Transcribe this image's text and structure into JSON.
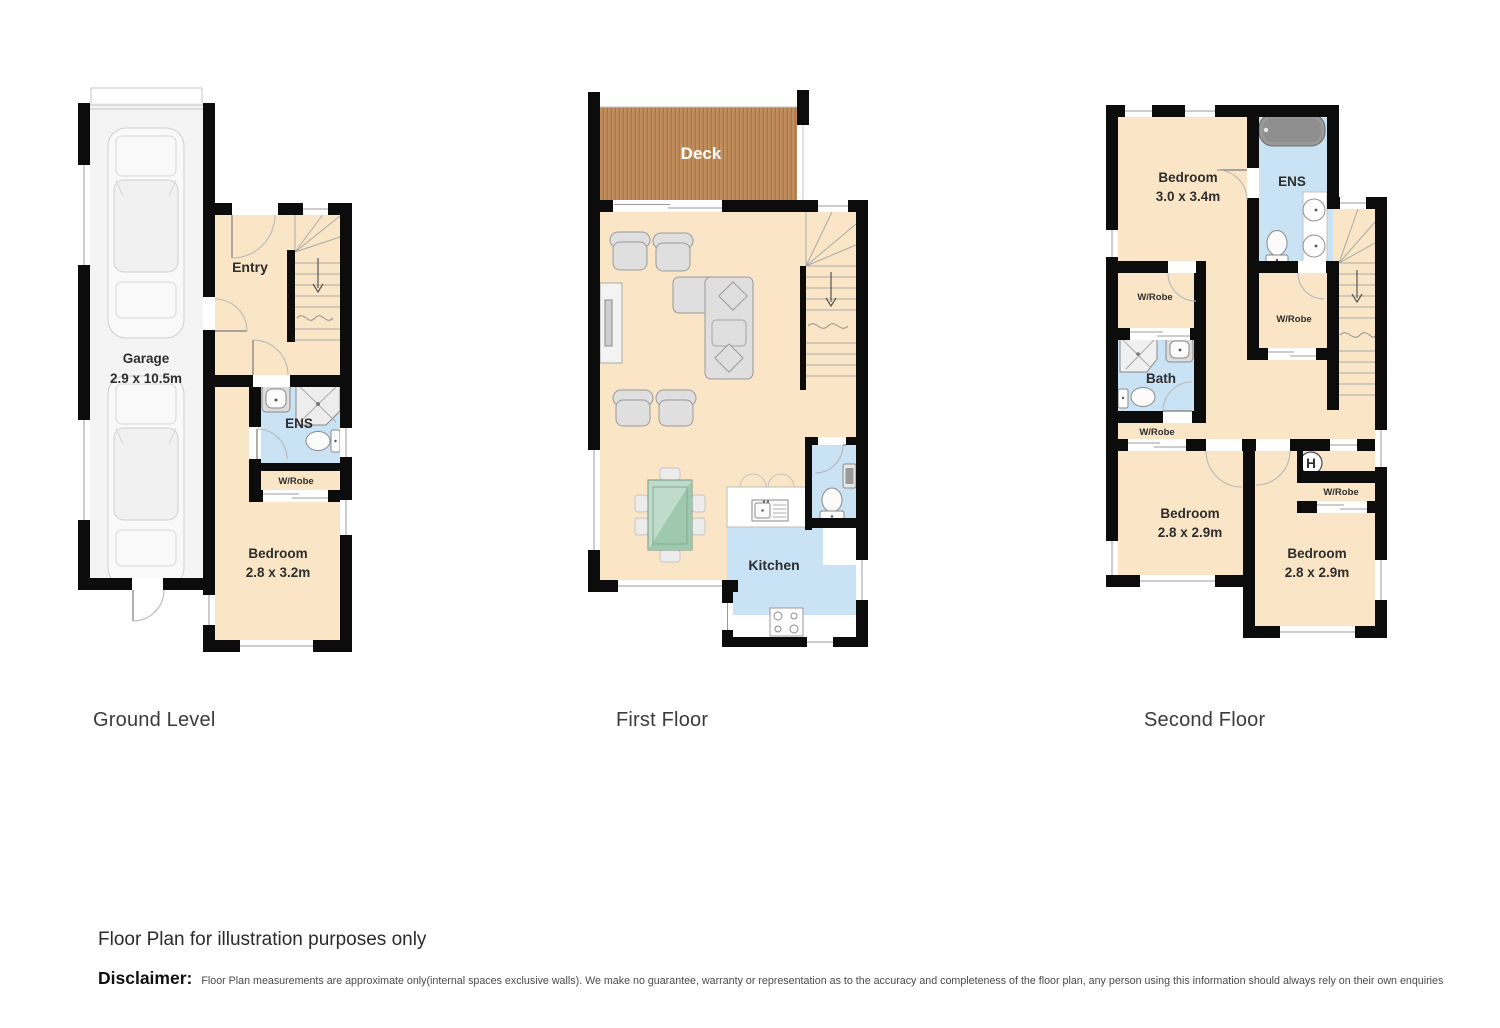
{
  "floors": {
    "ground": {
      "title": "Ground Level",
      "rooms": {
        "garage": {
          "name": "Garage",
          "dims": "2.9 x 10.5m"
        },
        "entry": {
          "name": "Entry"
        },
        "ens": {
          "name": "ENS"
        },
        "wrobe": {
          "name": "W/Robe"
        },
        "bedroom": {
          "name": "Bedroom",
          "dims": "2.8 x 3.2m"
        }
      }
    },
    "first": {
      "title": "First Floor",
      "rooms": {
        "deck": {
          "name": "Deck"
        },
        "kitchen": {
          "name": "Kitchen"
        }
      }
    },
    "second": {
      "title": "Second Floor",
      "rooms": {
        "bedroom1": {
          "name": "Bedroom",
          "dims": "3.0 x 3.4m"
        },
        "ens": {
          "name": "ENS"
        },
        "wrobe_left": {
          "name": "W/Robe"
        },
        "wrobe_center": {
          "name": "W/Robe"
        },
        "bath": {
          "name": "Bath"
        },
        "wrobe_small": {
          "name": "W/Robe"
        },
        "bedroom2": {
          "name": "Bedroom",
          "dims": "2.8 x 2.9m"
        },
        "hotwater": {
          "name": "H"
        },
        "wrobe_right": {
          "name": "W/Robe"
        },
        "bedroom3": {
          "name": "Bedroom",
          "dims": "2.8 x 2.9m"
        }
      }
    }
  },
  "footer": {
    "note": "Floor Plan for illustration purposes only",
    "disclaimer_label": "Disclaimer:",
    "disclaimer_text": "Floor Plan measurements are approximate only(internal spaces exclusive walls). We make no guarantee, warranty or representation as to the accuracy and completeness of the floor plan, any person using this information should always rely on their own enquiries"
  },
  "colors": {
    "wall": "#0c0c0c",
    "floor_cream": "#fae6c6",
    "wet_area_blue": "#c9e2f4",
    "deck_brown": "#c28e5e",
    "deck_stripe": "#a97945",
    "garage_grey": "#f4f4f4",
    "table_green": "#bfdccb"
  }
}
